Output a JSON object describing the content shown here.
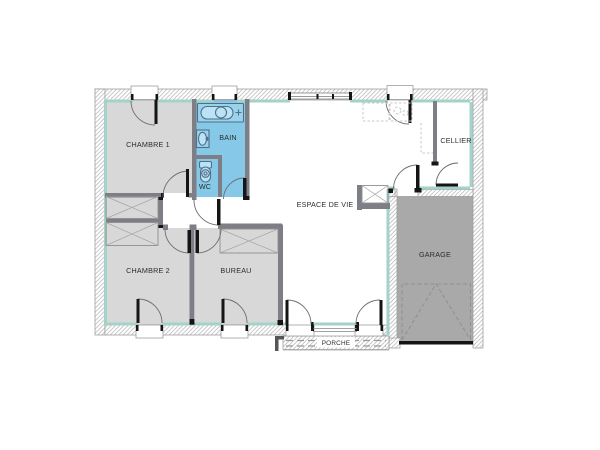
{
  "rooms": {
    "chambre1": {
      "label": "CHAMBRE 1"
    },
    "bain": {
      "label": "BAIN"
    },
    "wc": {
      "label": "WC"
    },
    "espace_de_vie": {
      "label": "ESPACE DE VIE"
    },
    "cellier": {
      "label": "CELLIER"
    },
    "garage": {
      "label": "GARAGE"
    },
    "chambre2": {
      "label": "CHAMBRE 2"
    },
    "bureau": {
      "label": "BUREAU"
    },
    "porche": {
      "label": "PORCHE"
    }
  },
  "icons": [
    "bathtub-icon",
    "sink-icon",
    "toilet-icon"
  ],
  "colors": {
    "background": "#ffffff",
    "room_fill": "#d8d8d8",
    "wet_room_fill": "#85c8e8",
    "garage_fill": "#a9a9a9",
    "wall_interior": "#7e7e86",
    "insulation_accent": "#a3d2c8",
    "fixture_fill": "#9ad2ee",
    "fixture_inner_fill": "#bce2f5"
  }
}
